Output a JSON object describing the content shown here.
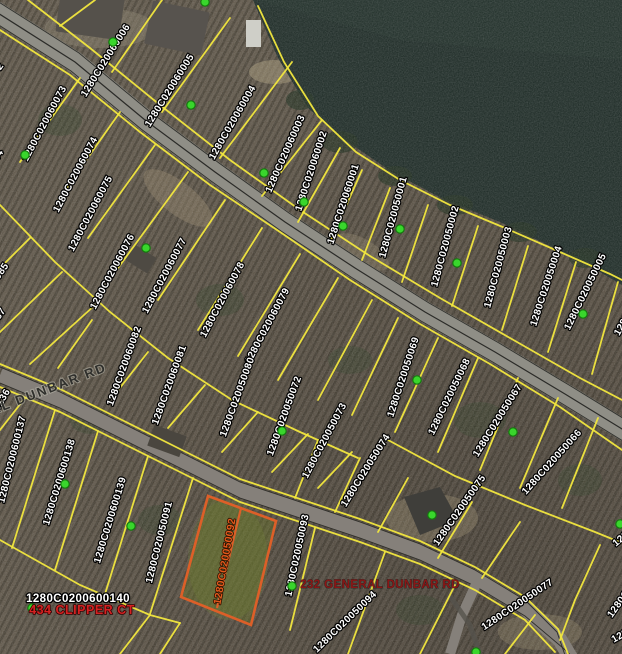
{
  "map": {
    "colors": {
      "land": "#5c5345",
      "land_dark": "#4c443a",
      "lake": "#1a2823",
      "parcel_line": "#f2e73e",
      "road_main": "#8f8e86",
      "road_secondary": "#85807a",
      "marker_green": "#39d62c",
      "marker_green_edge": "#157a0e",
      "highlight_orange": "#dd5f28",
      "label_white": "#ffffff",
      "address_red": "#d42222",
      "address_dark_red": "#8a1616"
    },
    "road_labels": [
      {
        "text": "GENERAL DUNBAR RD",
        "x": -60,
        "y": 435,
        "rot": -21
      }
    ],
    "selected_parcel": {
      "id": "1280C020050092",
      "label_x": 228,
      "label_y": 562,
      "label_rot": -80,
      "address": "232 GENERAL DUNBAR RD"
    },
    "address_labels": [
      {
        "text": "1280C0200600140",
        "style": "parcel-label-white-lg",
        "x": 78,
        "y": 602,
        "rot": 0
      },
      {
        "text": "434 CLIPPER CT",
        "style": "address-red",
        "x": 82,
        "y": 614,
        "rot": 0
      },
      {
        "text": "232 GENERAL DUNBAR RD",
        "style": "address-darkred",
        "x": 380,
        "y": 588,
        "rot": 0
      }
    ],
    "parcel_labels": [
      {
        "id": "1280C020060006",
        "x": 108,
        "y": 62,
        "rot": -58
      },
      {
        "id": "1280C020060005",
        "x": 172,
        "y": 92,
        "rot": -58
      },
      {
        "id": "1280C020060004",
        "x": 235,
        "y": 124,
        "rot": -60
      },
      {
        "id": "1280C020060003",
        "x": 288,
        "y": 155,
        "rot": -66
      },
      {
        "id": "1280C020060002",
        "x": 314,
        "y": 172,
        "rot": -72
      },
      {
        "id": "1280C020060001",
        "x": 346,
        "y": 205,
        "rot": -72
      },
      {
        "id": "1280C020050001",
        "x": 396,
        "y": 218,
        "rot": -75
      },
      {
        "id": "1280C020050002",
        "x": 448,
        "y": 247,
        "rot": -75
      },
      {
        "id": "1280C020050003",
        "x": 501,
        "y": 268,
        "rot": -75
      },
      {
        "id": "1280C020050004",
        "x": 549,
        "y": 287,
        "rot": -72
      },
      {
        "id": "1280C020050005",
        "x": 588,
        "y": 293,
        "rot": -64
      },
      {
        "id": "1280C020050006",
        "x": 640,
        "y": 300,
        "rot": -60
      },
      {
        "id": "1280C020060072",
        "x": -20,
        "y": 100,
        "rot": -55
      },
      {
        "id": "1280C020060073",
        "x": 47,
        "y": 125,
        "rot": -62
      },
      {
        "id": "1280C0200600144",
        "x": -20,
        "y": 190,
        "rot": -58
      },
      {
        "id": "1280C020060074",
        "x": 78,
        "y": 176,
        "rot": -62
      },
      {
        "id": "1280C020060075",
        "x": 93,
        "y": 215,
        "rot": -62
      },
      {
        "id": "1280C020060076",
        "x": 115,
        "y": 273,
        "rot": -62
      },
      {
        "id": "1280C020060086",
        "x": -25,
        "y": 262,
        "rot": -55
      },
      {
        "id": "1280C020060085",
        "x": -15,
        "y": 300,
        "rot": -55
      },
      {
        "id": "1280C020060087",
        "x": -18,
        "y": 345,
        "rot": -55
      },
      {
        "id": "1280C020060077",
        "x": 167,
        "y": 277,
        "rot": -62
      },
      {
        "id": "1280C020060078",
        "x": 225,
        "y": 301,
        "rot": -62
      },
      {
        "id": "1280C020060079",
        "x": 270,
        "y": 327,
        "rot": -62
      },
      {
        "id": "1280C020060082",
        "x": 127,
        "y": 367,
        "rot": -70
      },
      {
        "id": "1280C020060081",
        "x": 172,
        "y": 386,
        "rot": -70
      },
      {
        "id": "1280C020050080",
        "x": 240,
        "y": 398,
        "rot": -70
      },
      {
        "id": "1280C020050072",
        "x": 287,
        "y": 417,
        "rot": -70
      },
      {
        "id": "1280C020050069",
        "x": 406,
        "y": 378,
        "rot": -72
      },
      {
        "id": "1280C020050068",
        "x": 452,
        "y": 398,
        "rot": -64
      },
      {
        "id": "1280C020050067",
        "x": 500,
        "y": 422,
        "rot": -58
      },
      {
        "id": "1280C020050066",
        "x": 554,
        "y": 464,
        "rot": -48
      },
      {
        "id": "1280C020050073",
        "x": 327,
        "y": 442,
        "rot": -62
      },
      {
        "id": "1280C020050074",
        "x": 368,
        "y": 472,
        "rot": -58
      },
      {
        "id": "1280C020050075",
        "x": 462,
        "y": 512,
        "rot": -55
      },
      {
        "id": "1280C0200600136",
        "x": -12,
        "y": 430,
        "rot": -60
      },
      {
        "id": "1280C0200600137",
        "x": 15,
        "y": 460,
        "rot": -76
      },
      {
        "id": "1280C0200600138",
        "x": 62,
        "y": 483,
        "rot": -73
      },
      {
        "id": "1280C0200600139",
        "x": 113,
        "y": 521,
        "rot": -73
      },
      {
        "id": "1280C020050091",
        "x": 162,
        "y": 543,
        "rot": -76
      },
      {
        "id": "1280C020050093",
        "x": 300,
        "y": 556,
        "rot": -78
      },
      {
        "id": "1280C020050094",
        "x": 347,
        "y": 624,
        "rot": -44
      },
      {
        "id": "1280C020050077",
        "x": 519,
        "y": 607,
        "rot": -34
      },
      {
        "id": "1280C020050076",
        "x": 636,
        "y": 584,
        "rot": -55
      },
      {
        "id": "1280C020050065",
        "x": 648,
        "y": 520,
        "rot": -40
      },
      {
        "id": "1280C020050078",
        "x": 650,
        "y": 622,
        "rot": -30
      }
    ],
    "markers": [
      [
        205,
        2
      ],
      [
        113,
        42
      ],
      [
        191,
        105
      ],
      [
        25,
        155
      ],
      [
        264,
        173
      ],
      [
        304,
        202
      ],
      [
        343,
        226
      ],
      [
        400,
        229
      ],
      [
        457,
        263
      ],
      [
        583,
        314
      ],
      [
        146,
        248
      ],
      [
        282,
        431
      ],
      [
        417,
        380
      ],
      [
        513,
        432
      ],
      [
        432,
        515
      ],
      [
        620,
        524
      ],
      [
        65,
        484
      ],
      [
        131,
        526
      ],
      [
        32,
        608
      ],
      [
        292,
        586
      ],
      [
        476,
        652
      ]
    ]
  }
}
